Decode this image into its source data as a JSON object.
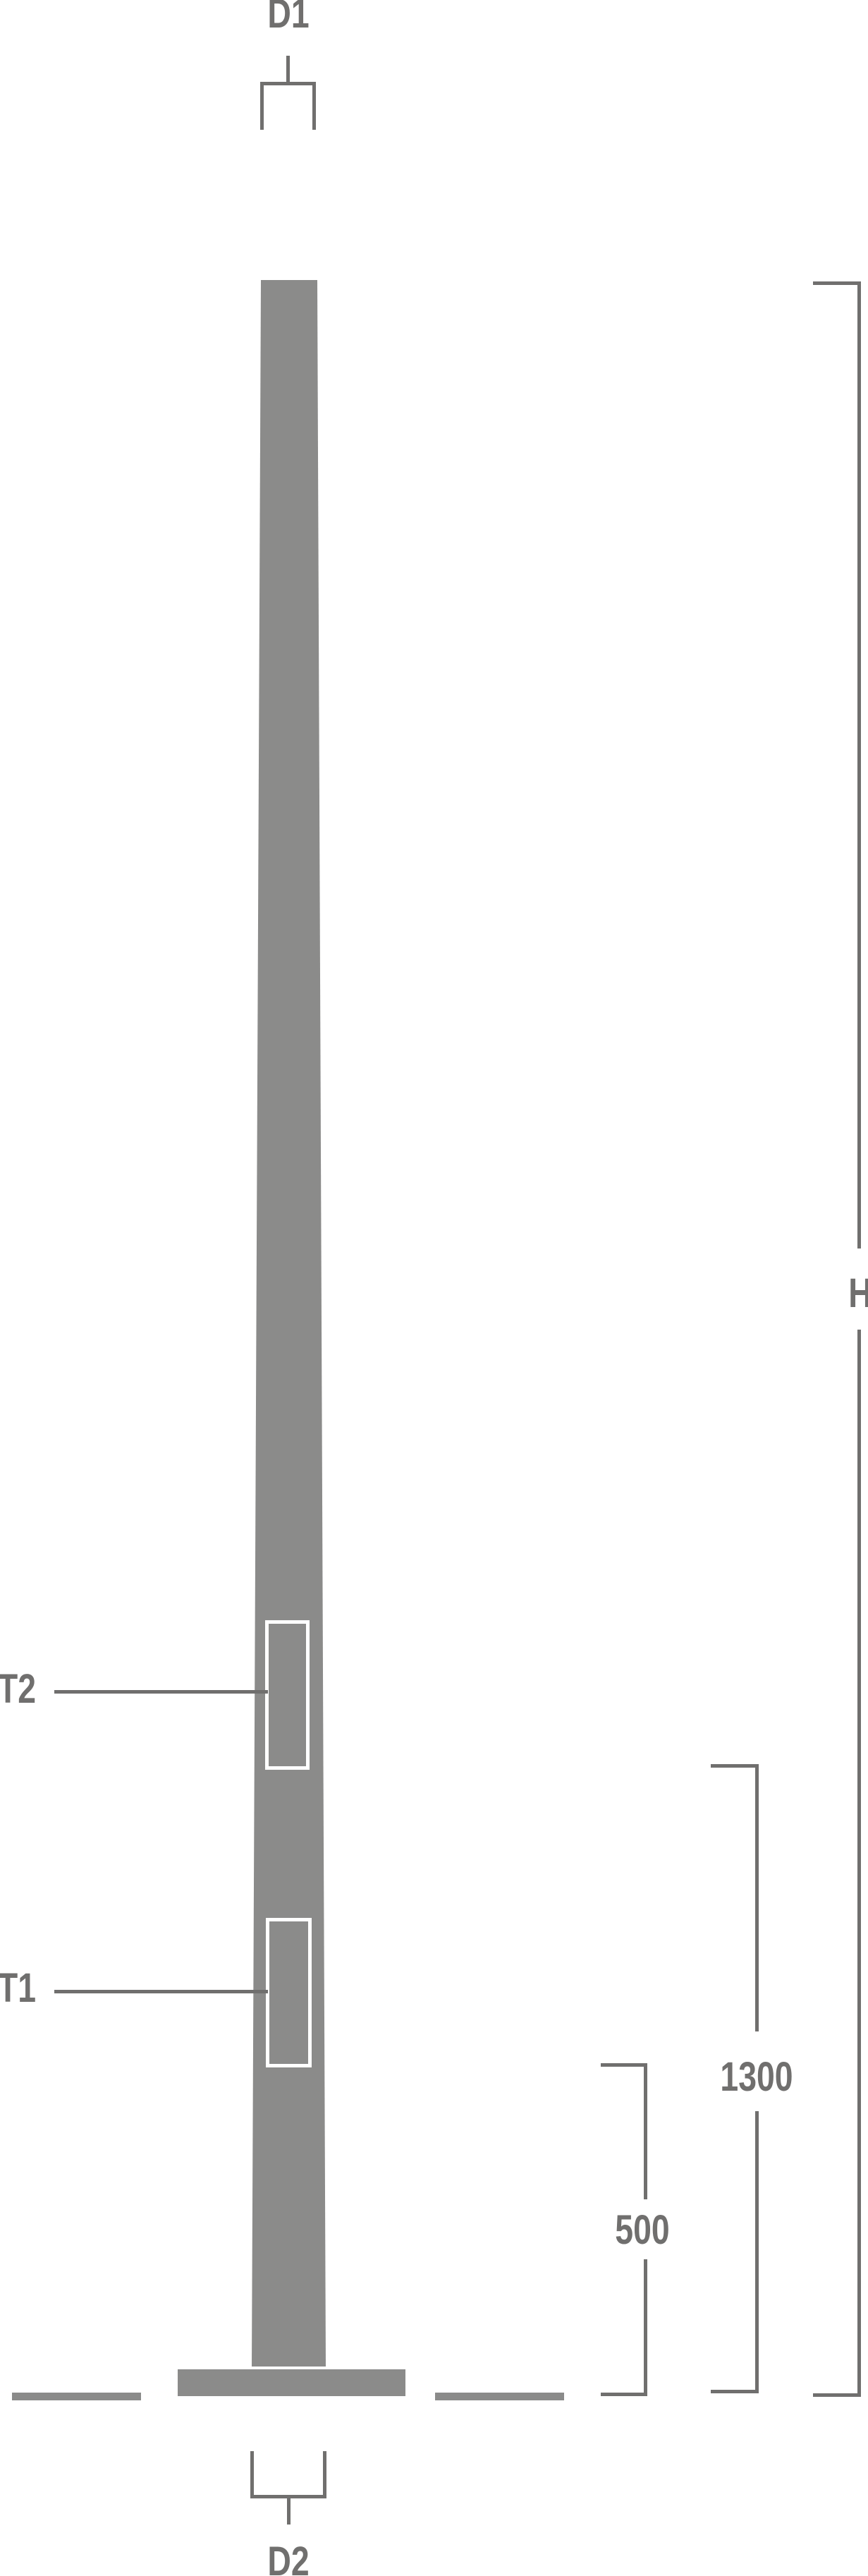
{
  "diagram": {
    "type": "technical-drawing",
    "subject": "Tapered pole elevation with dimension annotations",
    "labels": {
      "d1": "D1",
      "d2": "D2",
      "h": "H",
      "t1": "T1",
      "t2": "T2",
      "dim_1300": "1300",
      "dim_500": "500"
    },
    "colors": {
      "background": "#ffffff",
      "fill": "#8b8b8a",
      "line": "#706f6e",
      "plate_outline": "#ffffff"
    }
  }
}
